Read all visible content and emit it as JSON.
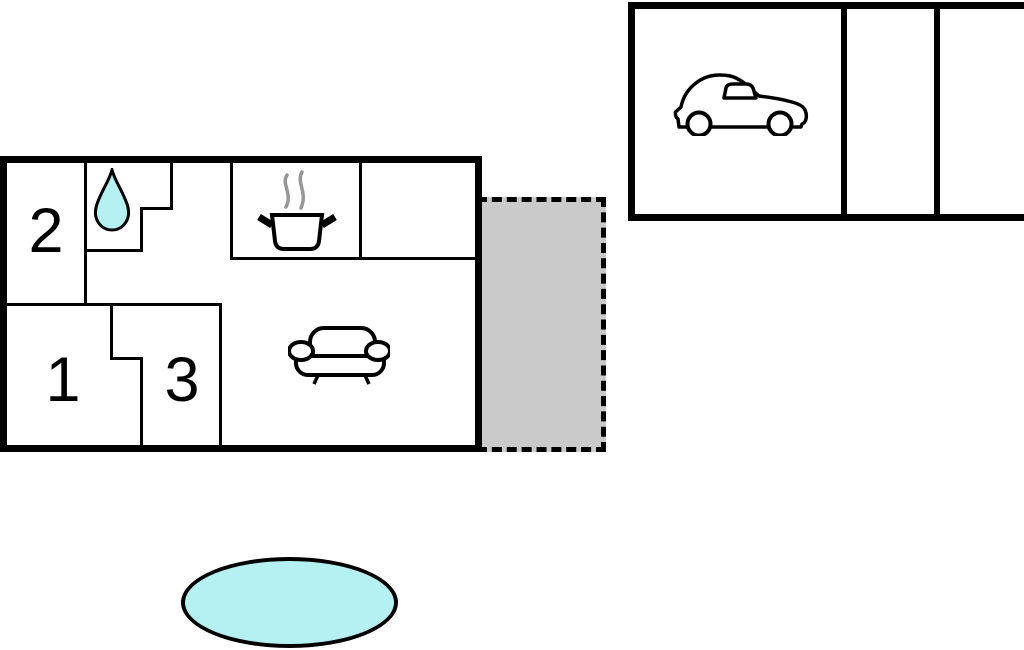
{
  "colors": {
    "wall": "#000000",
    "water": "#b5f1f2",
    "terrace": "#cacaca",
    "steam": "#969696",
    "background": "#ffffff"
  },
  "floorplan": {
    "type": "floor-plan",
    "rooms": [
      {
        "label": "1"
      },
      {
        "label": "2"
      },
      {
        "label": "3"
      }
    ],
    "icons": [
      "water-drop-icon",
      "cooking-pot-icon",
      "sofa-icon",
      "car-icon"
    ],
    "areas": [
      "main-building",
      "terrace",
      "garage",
      "pool"
    ]
  }
}
